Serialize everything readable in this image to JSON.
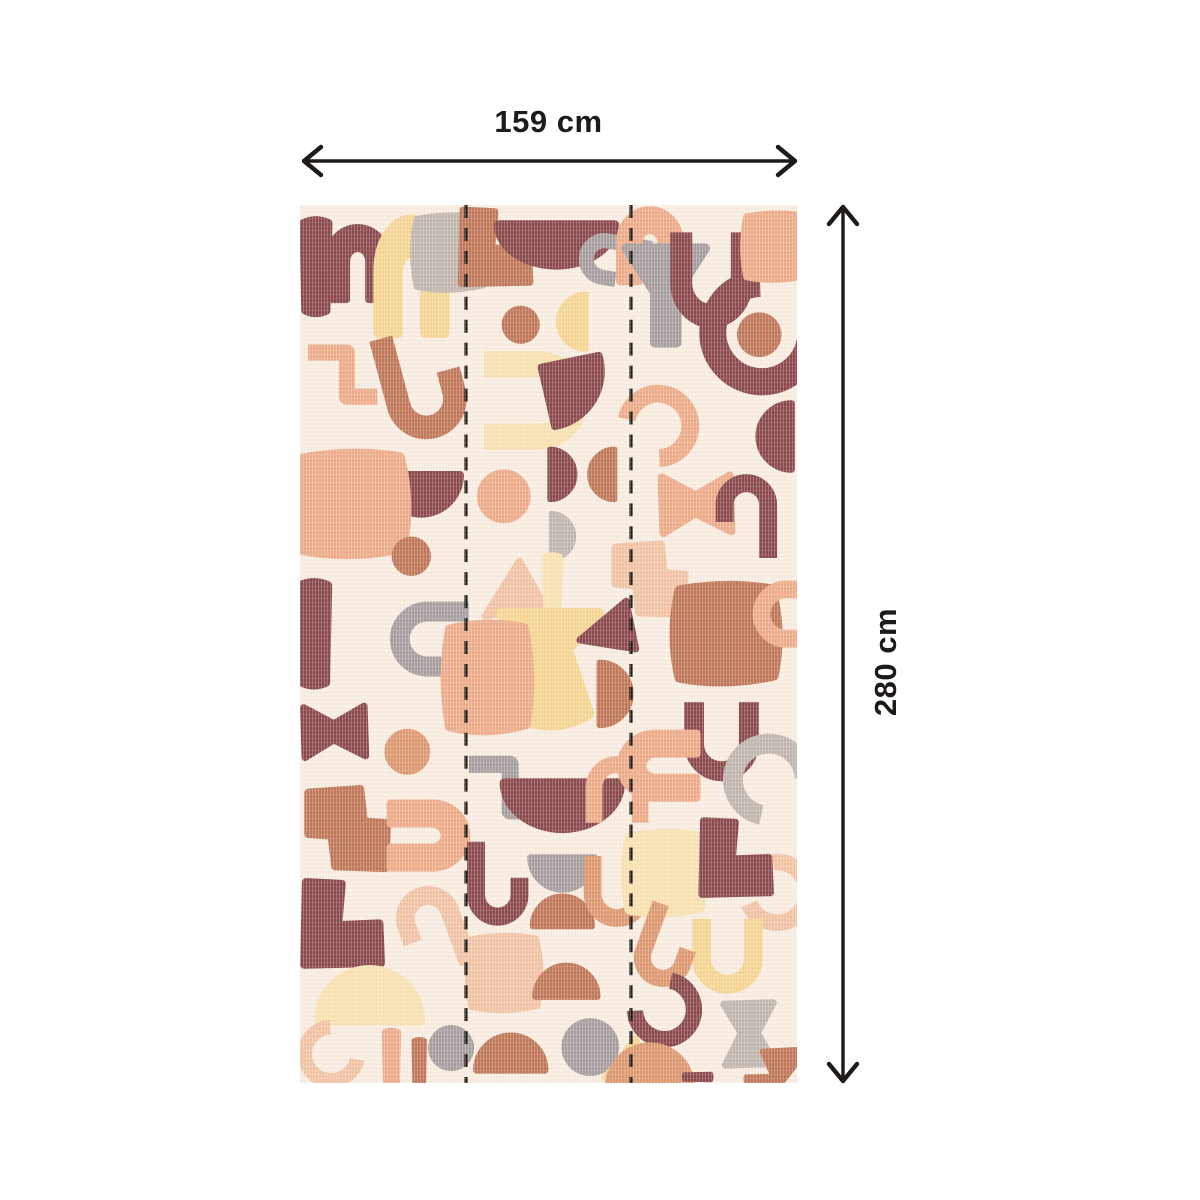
{
  "page": {
    "background": "#ffffff"
  },
  "dimensions": {
    "width_label": "159 cm",
    "height_label": "280 cm",
    "arrow_color": "#1d1a18"
  },
  "panel": {
    "background": "#FAEEE2",
    "seam_color": "#1F1B17",
    "seams": [
      167,
      333
    ],
    "palette": {
      "burgundy": "#8B4A4E",
      "terracotta": "#C2795A",
      "orange": "#E09A73",
      "peach": "#EFAE8B",
      "lightpeach": "#F4C5A6",
      "yellow": "#F7D794",
      "paleyellow": "#FAE3B2",
      "gray": "#A9A1A1",
      "lightgray": "#C2B8B1"
    },
    "shapes": [
      {
        "t": "bar",
        "x": 16,
        "y": 62,
        "s": 0.95,
        "c": "burgundy"
      },
      {
        "t": "arch",
        "x": 58,
        "y": 58,
        "s": 0.8,
        "c": "burgundy"
      },
      {
        "t": "arch",
        "x": 112,
        "y": 70,
        "s": 0.9,
        "sy": 1.25,
        "c": "yellow"
      },
      {
        "t": "blob",
        "x": 150,
        "y": 48,
        "s": 0.8,
        "c": "lightgray"
      },
      {
        "t": "zline",
        "x": 42,
        "y": 170,
        "s": 0.85,
        "c": "peach"
      },
      {
        "t": "jhook",
        "x": 122,
        "y": 180,
        "s": 1.25,
        "r": -15,
        "c": "terracotta"
      },
      {
        "t": "dome",
        "x": 122,
        "y": 290,
        "s": 0.85,
        "r": 180,
        "c": "burgundy"
      },
      {
        "t": "blob",
        "x": 52,
        "y": 300,
        "s": 1.2,
        "sy": 1.1,
        "c": "peach"
      },
      {
        "t": "bar",
        "x": 14,
        "y": 430,
        "s": 1.05,
        "c": "burgundy"
      },
      {
        "t": "circle",
        "x": 112,
        "y": 352,
        "s": 0.6,
        "c": "terracotta"
      },
      {
        "t": "uline",
        "x": 128,
        "y": 435,
        "s": 0.95,
        "r": 90,
        "c": "gray"
      },
      {
        "t": "bowtie",
        "x": 34,
        "y": 528,
        "s": 0.8,
        "c": "burgundy"
      },
      {
        "t": "circle",
        "x": 108,
        "y": 548,
        "s": 0.7,
        "c": "orange"
      },
      {
        "t": "sblock",
        "x": 48,
        "y": 625,
        "s": 0.9,
        "c": "terracotta"
      },
      {
        "t": "arch",
        "x": 130,
        "y": 632,
        "s": 0.85,
        "r": 90,
        "c": "peach"
      },
      {
        "t": "lblock",
        "x": 42,
        "y": 720,
        "s": 0.9,
        "c": "burgundy"
      },
      {
        "t": "jhook",
        "x": 134,
        "y": 726,
        "s": 1.0,
        "r": 160,
        "c": "lightpeach"
      },
      {
        "t": "dome",
        "x": 70,
        "y": 792,
        "s": 1.1,
        "c": "paleyellow"
      },
      {
        "t": "cshape",
        "x": 30,
        "y": 852,
        "s": 0.7,
        "r": -40,
        "c": "lightpeach"
      },
      {
        "t": "bar",
        "x": 92,
        "y": 854,
        "s": 0.55,
        "c": "peach"
      },
      {
        "t": "bar",
        "x": 120,
        "y": 858,
        "s": 0.45,
        "c": "terracotta"
      },
      {
        "t": "circle",
        "x": 152,
        "y": 845,
        "s": 0.7,
        "c": "gray"
      },
      {
        "t": "lblock",
        "x": 196,
        "y": 42,
        "s": 0.8,
        "c": "terracotta"
      },
      {
        "t": "dome",
        "x": 258,
        "y": 40,
        "s": 0.9,
        "sx": 1.25,
        "r": 180,
        "c": "burgundy"
      },
      {
        "t": "jhook",
        "x": 316,
        "y": 55,
        "s": 0.8,
        "r": 100,
        "c": "gray"
      },
      {
        "t": "circle",
        "x": 222,
        "y": 120,
        "s": 0.58,
        "c": "terracotta"
      },
      {
        "t": "dome",
        "x": 274,
        "y": 117,
        "s": 0.6,
        "r": -90,
        "c": "yellow"
      },
      {
        "t": "uline",
        "x": 240,
        "y": 196,
        "s": 1.25,
        "r": -90,
        "c": "paleyellow"
      },
      {
        "t": "fan",
        "x": 276,
        "y": 186,
        "s": 0.8,
        "r": 170,
        "c": "burgundy"
      },
      {
        "t": "circle",
        "x": 205,
        "y": 292,
        "s": 0.82,
        "c": "peach"
      },
      {
        "t": "dome",
        "x": 264,
        "y": 270,
        "s": 0.55,
        "r": 90,
        "c": "burgundy"
      },
      {
        "t": "dome",
        "x": 304,
        "y": 270,
        "s": 0.55,
        "r": -90,
        "c": "terracotta"
      },
      {
        "t": "dome",
        "x": 264,
        "y": 332,
        "s": 0.5,
        "r": 90,
        "c": "lightgray"
      },
      {
        "t": "tri",
        "x": 214,
        "y": 385,
        "s": 0.8,
        "r": -6,
        "c": "lightpeach"
      },
      {
        "t": "bar",
        "x": 254,
        "y": 380,
        "s": 0.6,
        "c": "paleyellow"
      },
      {
        "t": "vase",
        "x": 252,
        "y": 472,
        "s": 1.35,
        "c": "yellow"
      },
      {
        "t": "blob",
        "x": 188,
        "y": 474,
        "s": 0.95,
        "sy": 1.15,
        "c": "peach"
      },
      {
        "t": "tri",
        "x": 314,
        "y": 420,
        "s": 0.75,
        "r": 12,
        "c": "burgundy"
      },
      {
        "t": "dome",
        "x": 317,
        "y": 490,
        "s": 0.68,
        "r": 90,
        "c": "terracotta"
      },
      {
        "t": "zline",
        "x": 206,
        "y": 584,
        "s": 0.9,
        "c": "gray"
      },
      {
        "t": "dome",
        "x": 264,
        "y": 602,
        "s": 1.0,
        "sx": 1.25,
        "r": 180,
        "c": "burgundy"
      },
      {
        "t": "uline",
        "x": 319,
        "y": 584,
        "s": 0.8,
        "r": 180,
        "c": "peach"
      },
      {
        "t": "jhook",
        "x": 198,
        "y": 680,
        "s": 0.95,
        "c": "burgundy"
      },
      {
        "t": "dome",
        "x": 264,
        "y": 670,
        "s": 0.7,
        "r": 180,
        "c": "gray"
      },
      {
        "t": "dome",
        "x": 264,
        "y": 708,
        "s": 0.65,
        "c": "terracotta"
      },
      {
        "t": "uline",
        "x": 319,
        "y": 690,
        "s": 0.85,
        "c": "orange"
      },
      {
        "t": "blob",
        "x": 205,
        "y": 770,
        "s": 0.8,
        "c": "lightpeach"
      },
      {
        "t": "dome",
        "x": 268,
        "y": 778,
        "s": 0.68,
        "c": "terracotta"
      },
      {
        "t": "circle",
        "x": 292,
        "y": 844,
        "s": 0.88,
        "c": "gray"
      },
      {
        "t": "dome",
        "x": 212,
        "y": 850,
        "s": 0.75,
        "c": "terracotta"
      },
      {
        "t": "tri",
        "x": 330,
        "y": 856,
        "s": 0.62,
        "c": "yellow"
      },
      {
        "t": "arch",
        "x": 352,
        "y": 40,
        "s": 0.8,
        "c": "peach"
      },
      {
        "t": "funnel",
        "x": 368,
        "y": 94,
        "s": 1.1,
        "c": "gray"
      },
      {
        "t": "uline",
        "x": 414,
        "y": 78,
        "s": 1.05,
        "sy": 1.15,
        "c": "burgundy"
      },
      {
        "t": "circle",
        "x": 462,
        "y": 130,
        "s": 0.68,
        "c": "terracotta"
      },
      {
        "t": "cshape",
        "x": 462,
        "y": 130,
        "s": 1.3,
        "r": -40,
        "c": "burgundy"
      },
      {
        "t": "blob",
        "x": 478,
        "y": 42,
        "s": 0.72,
        "c": "peach"
      },
      {
        "t": "cshape",
        "x": 362,
        "y": 220,
        "s": 0.85,
        "r": 140,
        "c": "peach"
      },
      {
        "t": "dome",
        "x": 478,
        "y": 232,
        "s": 0.72,
        "r": -90,
        "c": "burgundy"
      },
      {
        "t": "bowtie",
        "x": 398,
        "y": 300,
        "s": 0.9,
        "c": "peach"
      },
      {
        "t": "jhook",
        "x": 450,
        "y": 312,
        "s": 0.95,
        "r": 180,
        "c": "burgundy"
      },
      {
        "t": "sblock",
        "x": 352,
        "y": 375,
        "s": 0.8,
        "c": "lightpeach"
      },
      {
        "t": "blob",
        "x": 428,
        "y": 430,
        "s": 1.15,
        "sy": 1.05,
        "c": "terracotta"
      },
      {
        "t": "uline",
        "x": 489,
        "y": 410,
        "s": 0.85,
        "r": 90,
        "c": "peach"
      },
      {
        "t": "uline",
        "x": 424,
        "y": 540,
        "s": 0.95,
        "c": "burgundy"
      },
      {
        "t": "arch",
        "x": 360,
        "y": 562,
        "s": 0.85,
        "r": -90,
        "c": "peach"
      },
      {
        "t": "cshape",
        "x": 470,
        "y": 574,
        "s": 0.95,
        "r": 50,
        "c": "lightgray"
      },
      {
        "t": "blob",
        "x": 366,
        "y": 670,
        "s": 0.88,
        "c": "paleyellow"
      },
      {
        "t": "lblock",
        "x": 438,
        "y": 654,
        "s": 0.8,
        "c": "burgundy"
      },
      {
        "t": "cshape",
        "x": 482,
        "y": 690,
        "s": 0.8,
        "r": 210,
        "c": "lightpeach"
      },
      {
        "t": "uline",
        "x": 430,
        "y": 755,
        "s": 0.9,
        "c": "yellow"
      },
      {
        "t": "jhook",
        "x": 368,
        "y": 744,
        "s": 0.9,
        "r": 20,
        "c": "orange"
      },
      {
        "t": "cshape",
        "x": 368,
        "y": 808,
        "s": 0.78,
        "r": -130,
        "c": "burgundy"
      },
      {
        "t": "dome",
        "x": 352,
        "y": 864,
        "s": 0.9,
        "c": "orange"
      },
      {
        "t": "bowtie",
        "x": 452,
        "y": 830,
        "s": 0.8,
        "r": 90,
        "c": "lightgray"
      },
      {
        "t": "tri",
        "x": 488,
        "y": 864,
        "s": 0.6,
        "r": 180,
        "c": "terracotta"
      },
      {
        "t": "bar",
        "x": 400,
        "y": 874,
        "s": 0.3,
        "r": 90,
        "c": "burgundy"
      },
      {
        "t": "bar",
        "x": 462,
        "y": 876,
        "s": 0.3,
        "r": 90,
        "c": "terracotta"
      }
    ]
  }
}
